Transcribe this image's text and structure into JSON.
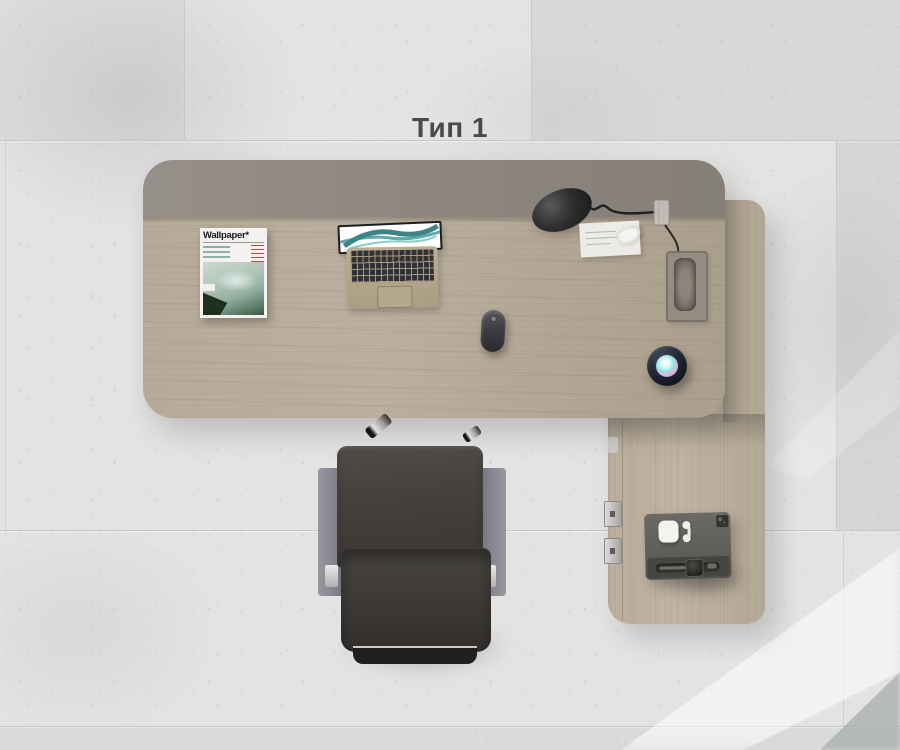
{
  "title": "Тип 1",
  "magazine": {
    "masthead": "Wallpaper*"
  },
  "palette": {
    "floor": "#e2e3e2",
    "tile_joint": "#c6c8c7",
    "desk_wood": "#b6aa98",
    "return_desk_wood": "#bcb1a0",
    "desk_back_panel": "#8e8780",
    "title_text": "#4a4a4c",
    "chair_leather": "#413d3a",
    "chair_armrest": "#8a898f",
    "device_body": "#5f5e59",
    "lamp_black": "#262626",
    "laptop_body": "#b3a489",
    "siri_orb_teal": "#8fe8df",
    "siri_orb_pink": "#f0a9d4",
    "siri_orb_purple": "#7a6cf0"
  }
}
